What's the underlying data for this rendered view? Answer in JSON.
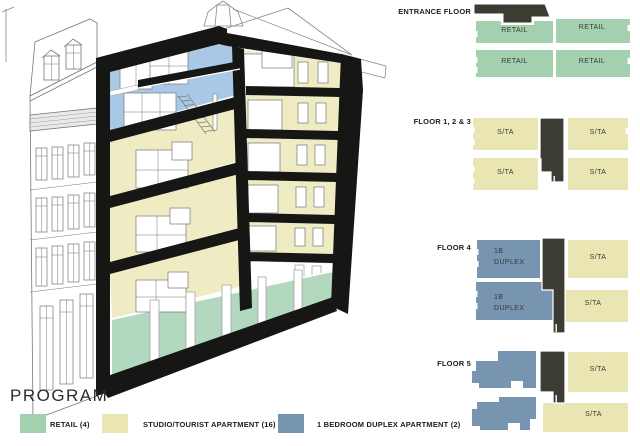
{
  "program": {
    "title": "PROGRAM",
    "legend": [
      {
        "label": "RETAIL (4)",
        "color": "#a3d1af"
      },
      {
        "label": "STUDIO/TOURIST APARTMENT (16)",
        "color": "#e9e6b4"
      },
      {
        "label": "1 BEDROOM DUPLEX APARTMENT (2)",
        "color": "#7795b1"
      }
    ]
  },
  "floor_plans": [
    {
      "label": "ENTRANCE FLOOR",
      "units": [
        "RETAIL",
        "RETAIL",
        "RETAIL",
        "RETAIL"
      ]
    },
    {
      "label": "FLOOR 1, 2 & 3",
      "units": [
        "S/TA",
        "S/TA",
        "S/TA",
        "S/TA"
      ]
    },
    {
      "label": "FLOOR 4",
      "units": [
        "1B\nDUPLEX",
        "S/TA",
        "1B\nDUPLEX",
        "S/TA"
      ]
    },
    {
      "label": "FLOOR 5",
      "units": [
        "S/TA",
        "S/TA"
      ]
    }
  ],
  "colors": {
    "retail_green": "#a3d1af",
    "studio_yellow": "#e9e6b4",
    "duplex_blue": "#7795b1",
    "core_dark": "#3d3c33",
    "section_blue": "#a9c8e6",
    "section_yellow": "#efecc4",
    "section_green": "#b2d9bf",
    "frame_black": "#161614"
  }
}
